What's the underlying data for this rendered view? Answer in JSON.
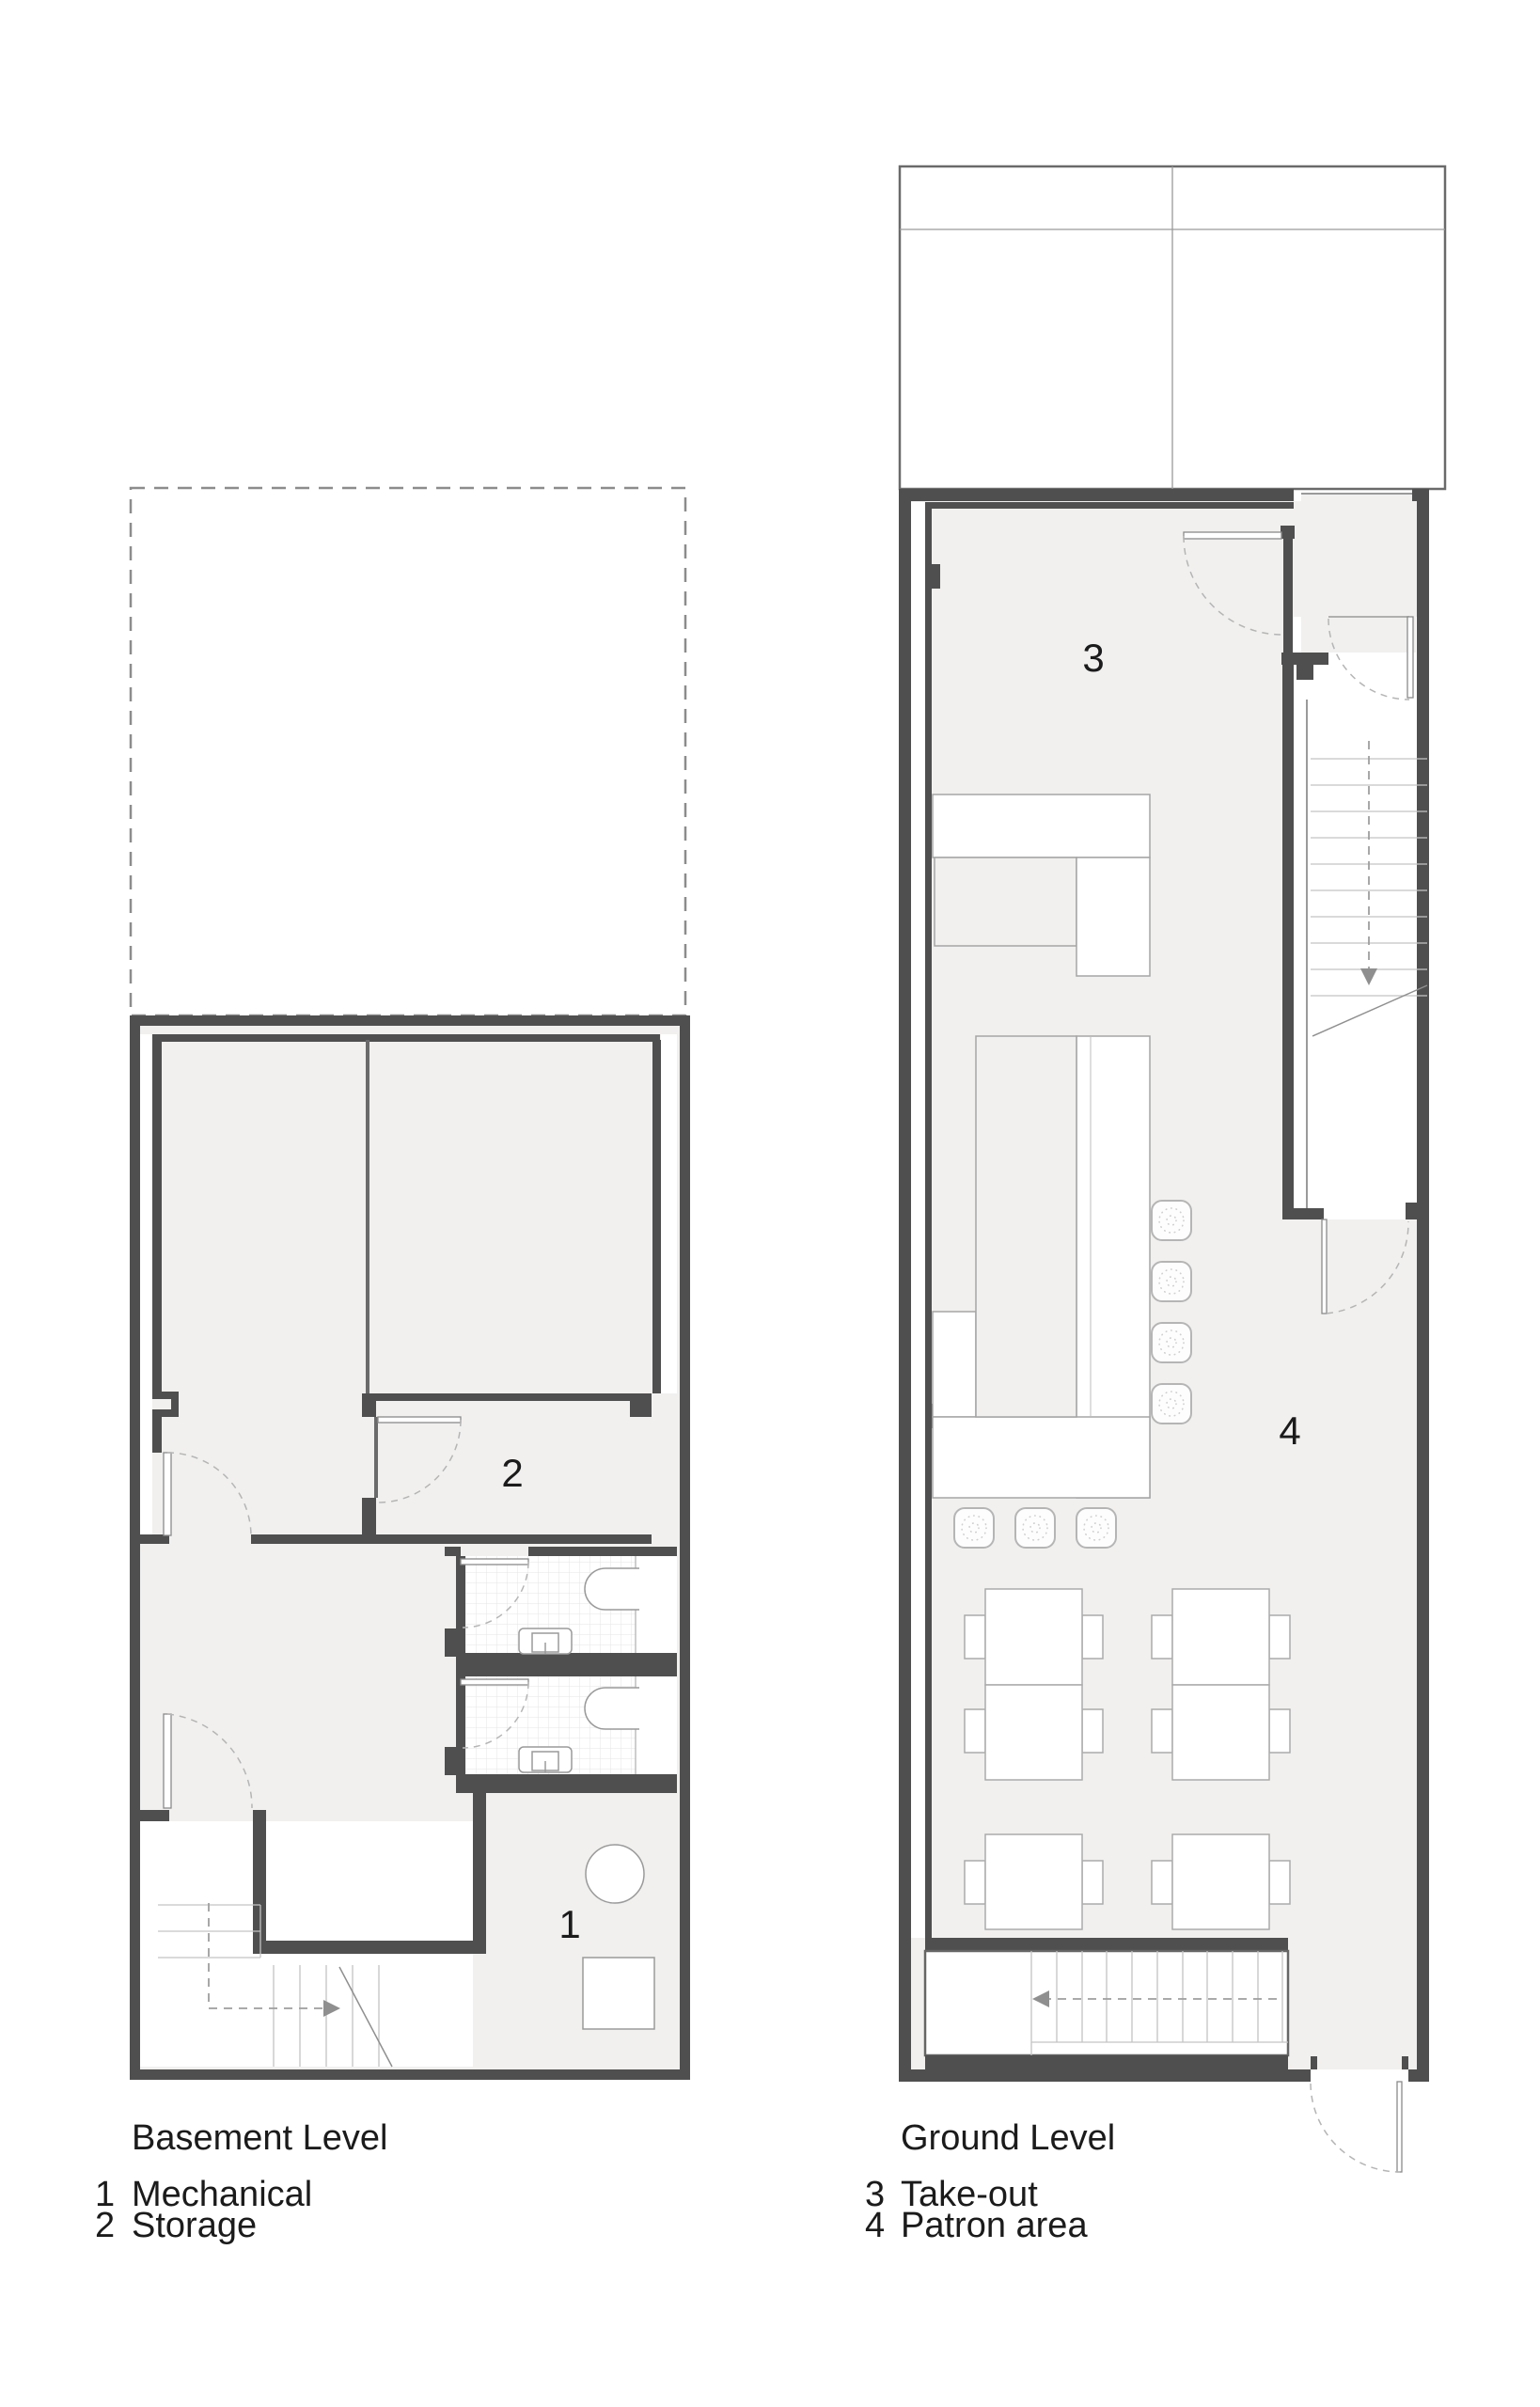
{
  "document": {
    "type": "architectural-floor-plan-sheet",
    "background": "#ffffff"
  },
  "colors": {
    "wall_dark": "#4f4f4f",
    "wall_medium": "#6a6a6a",
    "thin_line": "#9a9a9a",
    "furniture_outline": "#aaaaaa",
    "floor_gray": "#f1f0ef",
    "tile_grid": "#e4e4e4",
    "door_arc": "#b5b5b5",
    "stair_tread": "#c4c4c4",
    "dashed_outline": "#8c8c8c",
    "text": "#1b1b1b"
  },
  "basement": {
    "room_labels": {
      "mechanical": "1",
      "storage": "2"
    }
  },
  "ground": {
    "room_labels": {
      "takeout": "3",
      "patron": "4"
    }
  },
  "legend": {
    "basement": {
      "title": "Basement Level",
      "items": [
        {
          "num": "1",
          "label": "Mechanical"
        },
        {
          "num": "2",
          "label": "Storage"
        }
      ]
    },
    "ground": {
      "title": "Ground Level",
      "items": [
        {
          "num": "3",
          "label": "Take-out"
        },
        {
          "num": "4",
          "label": "Patron area"
        }
      ]
    }
  }
}
